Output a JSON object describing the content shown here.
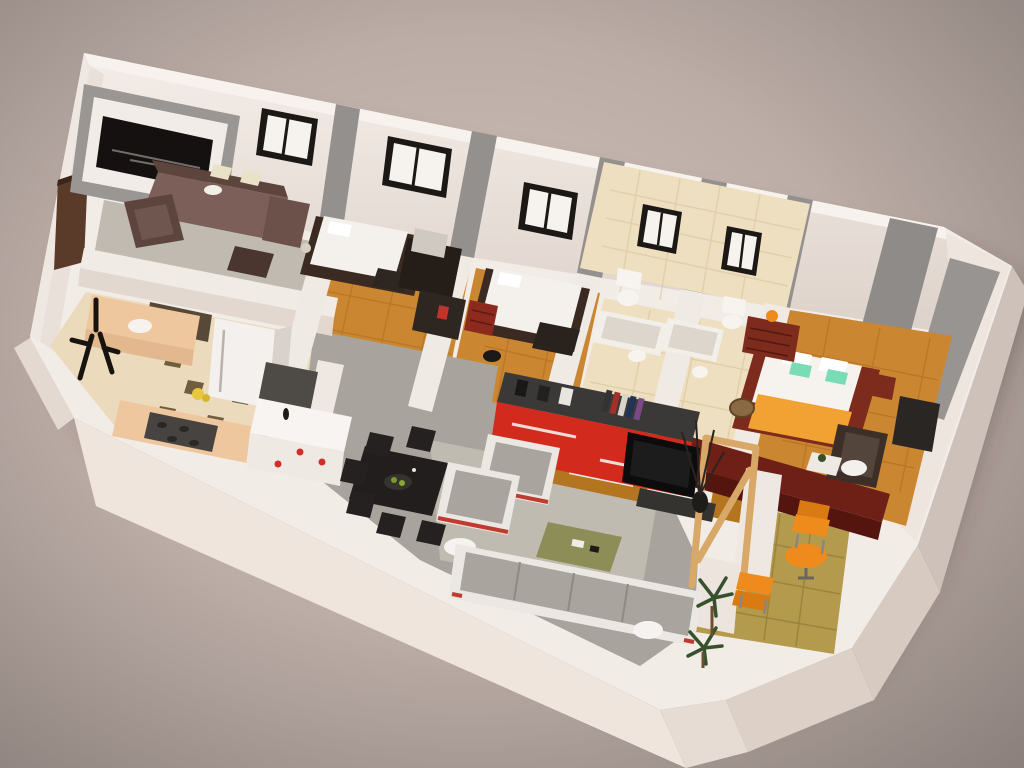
{
  "scene": {
    "type": "3d-floorplan-render",
    "view": "isometric-cutaway-apartment",
    "window_count": 5,
    "door_count": 1,
    "rooms": [
      {
        "name": "living-room",
        "floor": "carpet",
        "furniture": [
          "sectional-sofa",
          "armchair",
          "ottoman",
          "media-wall-panel",
          "cushions"
        ]
      },
      {
        "name": "bedroom-1",
        "floor": "wood",
        "furniture": [
          "single-bed",
          "vanity-desk",
          "shelf-unit",
          "lamp"
        ]
      },
      {
        "name": "bedroom-2",
        "floor": "wood",
        "furniture": [
          "single-bed",
          "drawer-chest",
          "round-stool"
        ]
      },
      {
        "name": "bathroom-1",
        "floor": "beige-tile",
        "furniture": [
          "toilet",
          "bathtub",
          "pedestal-sink"
        ]
      },
      {
        "name": "bathroom-2",
        "floor": "beige-tile",
        "furniture": [
          "toilet",
          "bathtub",
          "pedestal-sink"
        ]
      },
      {
        "name": "master-bedroom",
        "floor": "wood",
        "furniture": [
          "double-bed",
          "dresser",
          "nightstand",
          "armchair",
          "floor-tv-unit",
          "basket",
          "side-table",
          "lamp"
        ]
      },
      {
        "name": "kitchen",
        "floor": "checker-tile",
        "furniture": [
          "fridge",
          "sink-counter",
          "stove",
          "white-island",
          "coat-rack",
          "fruit-bowl"
        ]
      },
      {
        "name": "dining-living-area",
        "floor": "speckled-concrete",
        "furniture": [
          "dining-table",
          "dining-chairs",
          "lounge-armchairs",
          "corner-sofa",
          "coffee-table",
          "oval-side-tables",
          "red-sideboard",
          "flat-tv",
          "wood-room-divider",
          "branch-plant"
        ]
      },
      {
        "name": "balcony",
        "floor": "gold-tile",
        "furniture": [
          "orange-bistro-table",
          "orange-chair",
          "orange-chair",
          "palm-plants"
        ]
      }
    ]
  },
  "colors": {
    "bg_center": "#cdbfb7",
    "bg_edge": "#8c817d",
    "wall_cap": "#f2ece7",
    "wall_face_outer": "#efe5dd",
    "wall_face_side": "#ddd1c8",
    "gray_accent": "#94908d",
    "black_panel": "#141110",
    "window_frame": "#1c1815",
    "window_pane": "#f6f3ef",
    "door": "#5a3a28",
    "carpet": "#c0bab1",
    "rug": "#c6c0b5",
    "wood": "#ca8631",
    "wood_dark": "#b3751f",
    "concrete": "#a8a39c",
    "tile_cream": "#ecdabd",
    "checker_dark": "#6f5d3e",
    "bath_tile": "#eedfc0",
    "balcony_tile": "#b49a4d",
    "maroon": "#6e1f16",
    "master_furniture": "#7d2b1d",
    "sideboard_red": "#d32a1e",
    "sideboard_top": "#3b3937",
    "tv_black": "#0d0c0c",
    "sofa_gray": "#a9a49d",
    "sofa_frame": "#ebe7e2",
    "sofa_brown": "#7b5f58",
    "sofa_brown_dark": "#5d453e",
    "pillow_cream": "#e9e2c6",
    "dining_black": "#211e1d",
    "coffee_olive": "#8d8d58",
    "orange": "#ef8b1c",
    "blanket_orange": "#f2a133",
    "teal": "#7adcb4",
    "fixture_white": "#f7f4f0",
    "fridge": "#f3f0ed",
    "counter_peach": "#efc79f",
    "stove_dark": "#474340",
    "island_white": "#f7f4f1",
    "plant_green": "#35522c",
    "divider_wood": "#d8a868",
    "accent_red": "#d03028"
  }
}
